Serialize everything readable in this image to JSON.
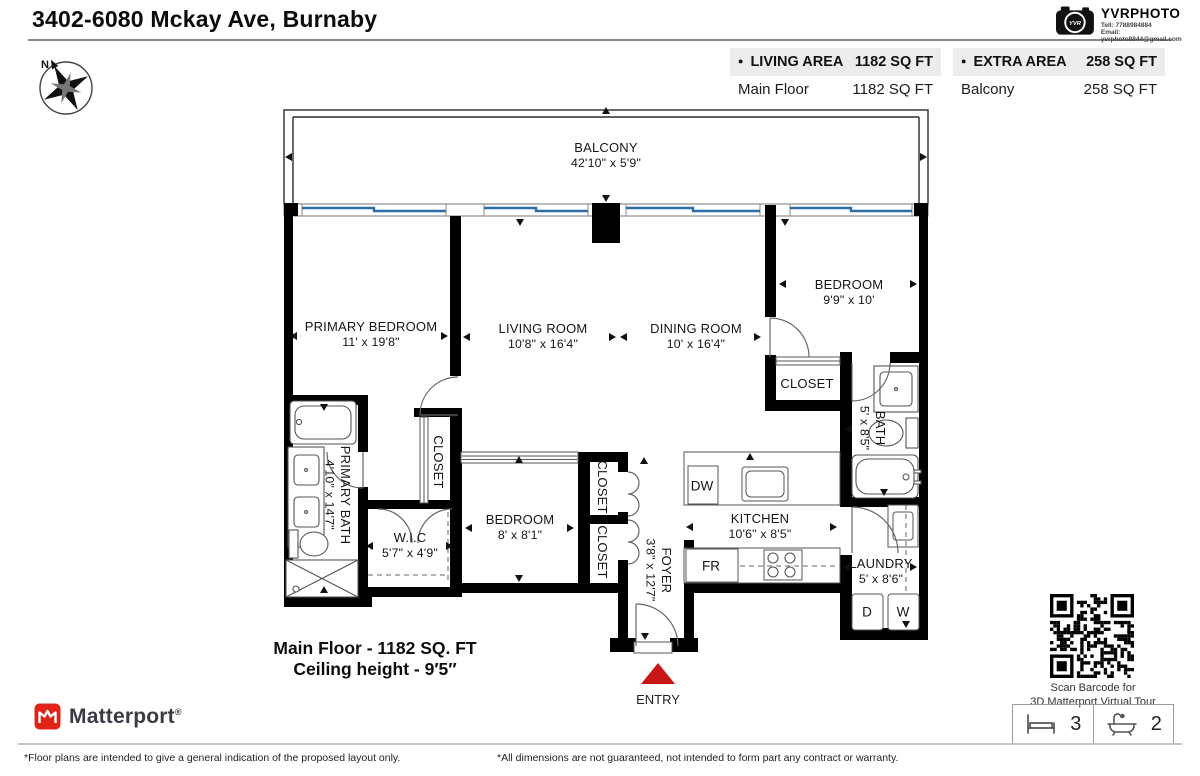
{
  "header": {
    "title": "3402-6080 Mckay Ave, Burnaby"
  },
  "branding": {
    "name": "YVRPHOTO",
    "camera_text": "YVR",
    "tel": "Tell:  7788984884",
    "email": "Email:  yvrphoto8844@gmail.com"
  },
  "compass": {
    "north_label": "N"
  },
  "area_summary": {
    "living": {
      "bullet": "●",
      "label": "LIVING AREA",
      "total": "1182 SQ FT",
      "row_name": "Main Floor",
      "row_value": "1182 SQ FT"
    },
    "extra": {
      "bullet": "●",
      "label": "EXTRA AREA",
      "total": "258 SQ FT",
      "row_name": "Balcony",
      "row_value": "258 SQ FT"
    }
  },
  "floorplan": {
    "rooms": [
      {
        "name": "BALCONY",
        "dims": "42'10\" x 5'9\""
      },
      {
        "name": "PRIMARY BEDROOM",
        "dims": "11' x 19'8\""
      },
      {
        "name": "LIVING ROOM",
        "dims": "10'8\" x 16'4\""
      },
      {
        "name": "DINING ROOM",
        "dims": "10' x 16'4\""
      },
      {
        "name": "BEDROOM",
        "dims": "9'9\" x 10'"
      },
      {
        "name": "CLOSET",
        "dims": ""
      },
      {
        "name": "BATH",
        "dims": "5' x 8'5\""
      },
      {
        "name": "PRIMARY BATH",
        "dims": "4'10\" x 14'7\""
      },
      {
        "name": "CLOSET",
        "dims": ""
      },
      {
        "name": "W.I.C",
        "dims": "5'7\" x 4'9\""
      },
      {
        "name": "BEDROOM",
        "dims": "8' x 8'1\""
      },
      {
        "name": "CLOSET",
        "dims": ""
      },
      {
        "name": "CLOSET",
        "dims": ""
      },
      {
        "name": "FOYER",
        "dims": "3'8\" x 12'7\""
      },
      {
        "name": "KITCHEN",
        "dims": "10'6\" x 8'5\""
      },
      {
        "name": "LAUNDRY",
        "dims": "5' x 8'6\""
      }
    ],
    "appliances": {
      "dishwasher": "DW",
      "fridge": "FR",
      "dryer": "D",
      "washer": "W"
    },
    "entry_label": "ENTRY",
    "summary_line1": "Main Floor - 1182 SQ. FT",
    "summary_line2": "Ceiling height - 9′5″"
  },
  "qr": {
    "caption_line1": "Scan Barcode for",
    "caption_line2": "3D Matterport Virtual Tour"
  },
  "stats": {
    "beds": "3",
    "baths": "2"
  },
  "matterport": {
    "brand": "Matterport",
    "registered": "®"
  },
  "footer": {
    "left": "*Floor plans are intended to give a general indication of the proposed layout only.",
    "right": "*All dimensions are not guaranteed, not intended to form part any contract or warranty."
  },
  "colors": {
    "window": "#2e6da4",
    "entry_arrow": "#c81616",
    "matterport_red": "#e2231a",
    "wall": "#000000"
  }
}
